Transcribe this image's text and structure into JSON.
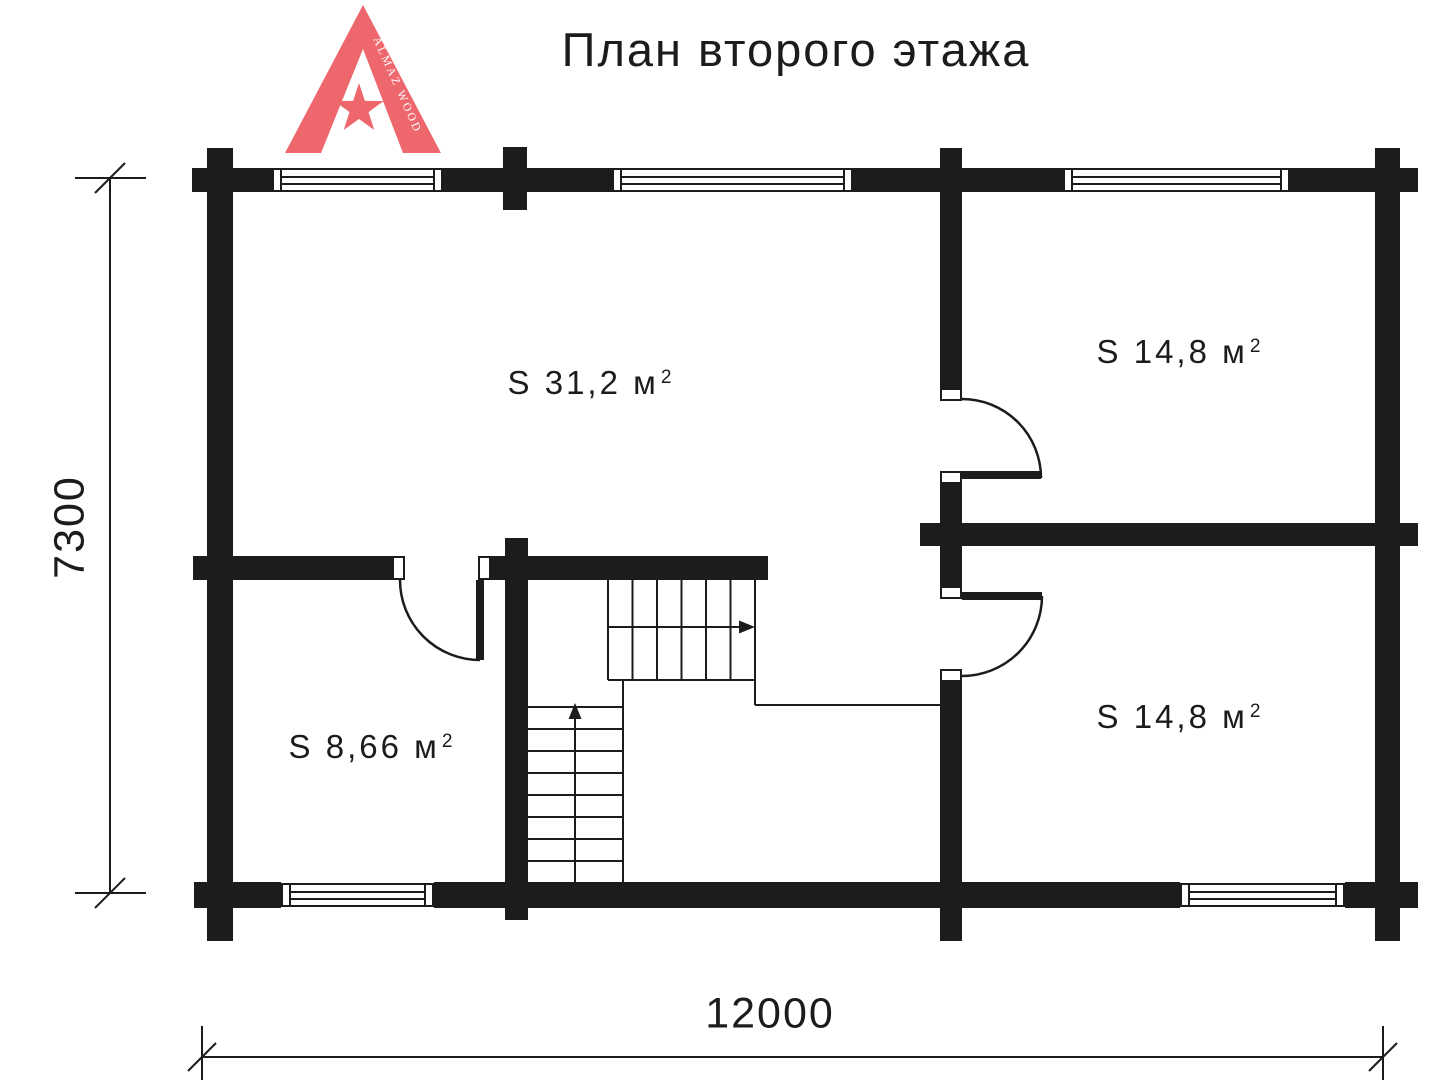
{
  "colors": {
    "ink": "#1c1c1c",
    "logo_accent": "#ee676d"
  },
  "header": {
    "title": "План второго этажа"
  },
  "logo": {
    "brand": "ALMAZ WOOD"
  },
  "rooms": [
    {
      "name": "hall",
      "area": "S 31,2 м",
      "sup": "2"
    },
    {
      "name": "top-right",
      "area": "S 14,8 м",
      "sup": "2"
    },
    {
      "name": "bottom-right",
      "area": "S 14,8 м",
      "sup": "2"
    },
    {
      "name": "bottom-left",
      "area": "S 8,66 м",
      "sup": "2"
    }
  ],
  "dimensions": {
    "bottom": "12000",
    "left": "7300"
  }
}
